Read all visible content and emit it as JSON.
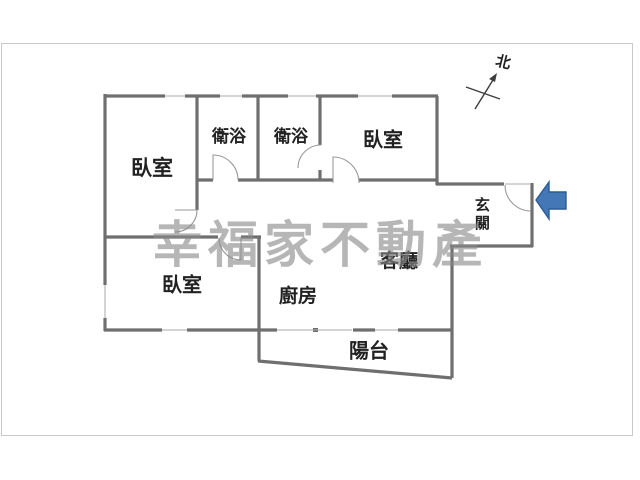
{
  "floorplan": {
    "watermark": "幸福家不動產",
    "compass": {
      "label": "北"
    },
    "rooms": [
      {
        "id": "bedroom-upper-left",
        "label": "臥室"
      },
      {
        "id": "bathroom-left",
        "label": "衛浴"
      },
      {
        "id": "bathroom-right",
        "label": "衛浴"
      },
      {
        "id": "bedroom-right",
        "label": "臥室"
      },
      {
        "id": "entry",
        "label": "玄關"
      },
      {
        "id": "living-room",
        "label": "客廳"
      },
      {
        "id": "bedroom-lower",
        "label": "臥室"
      },
      {
        "id": "kitchen",
        "label": "廚房"
      },
      {
        "id": "balcony",
        "label": "陽台"
      }
    ],
    "colors": {
      "background": "#ffffff",
      "frame": "#c9c9c9",
      "wall": "#6f6f6f",
      "thin": "#a9a9a9",
      "label": "#222222",
      "watermark": "#8a8a8a",
      "arrow_fill": "#4377b6",
      "arrow_border": "#2b5c94"
    }
  }
}
